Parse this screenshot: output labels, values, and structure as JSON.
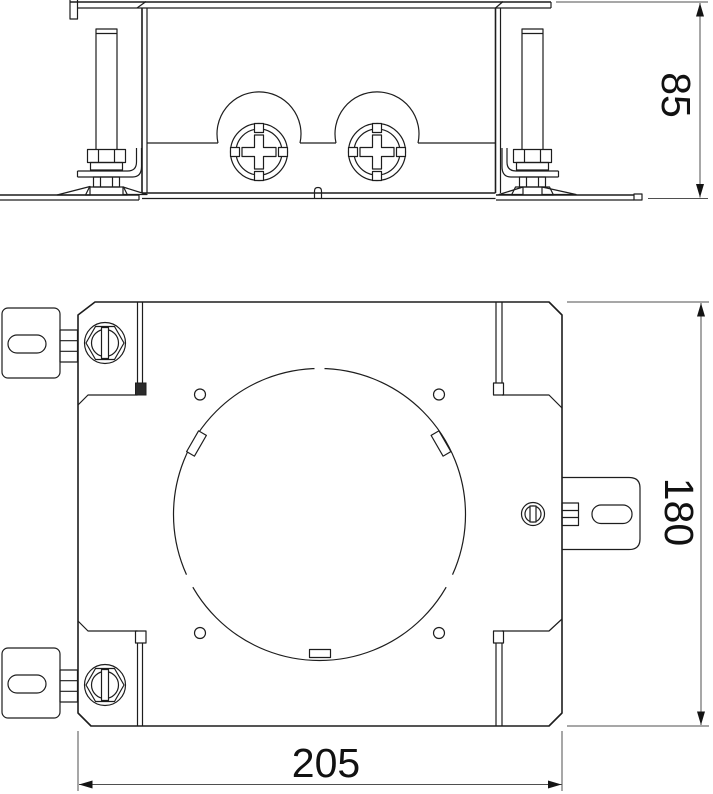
{
  "drawing": {
    "views": {
      "front_view": {
        "height_dimension": "85"
      },
      "plan_view": {
        "height_dimension": "180",
        "width_dimension": "205"
      }
    },
    "colors": {
      "outline": "#1d1d1d",
      "dimension_line": "#4f4f4f",
      "background": "#ffffff"
    }
  }
}
